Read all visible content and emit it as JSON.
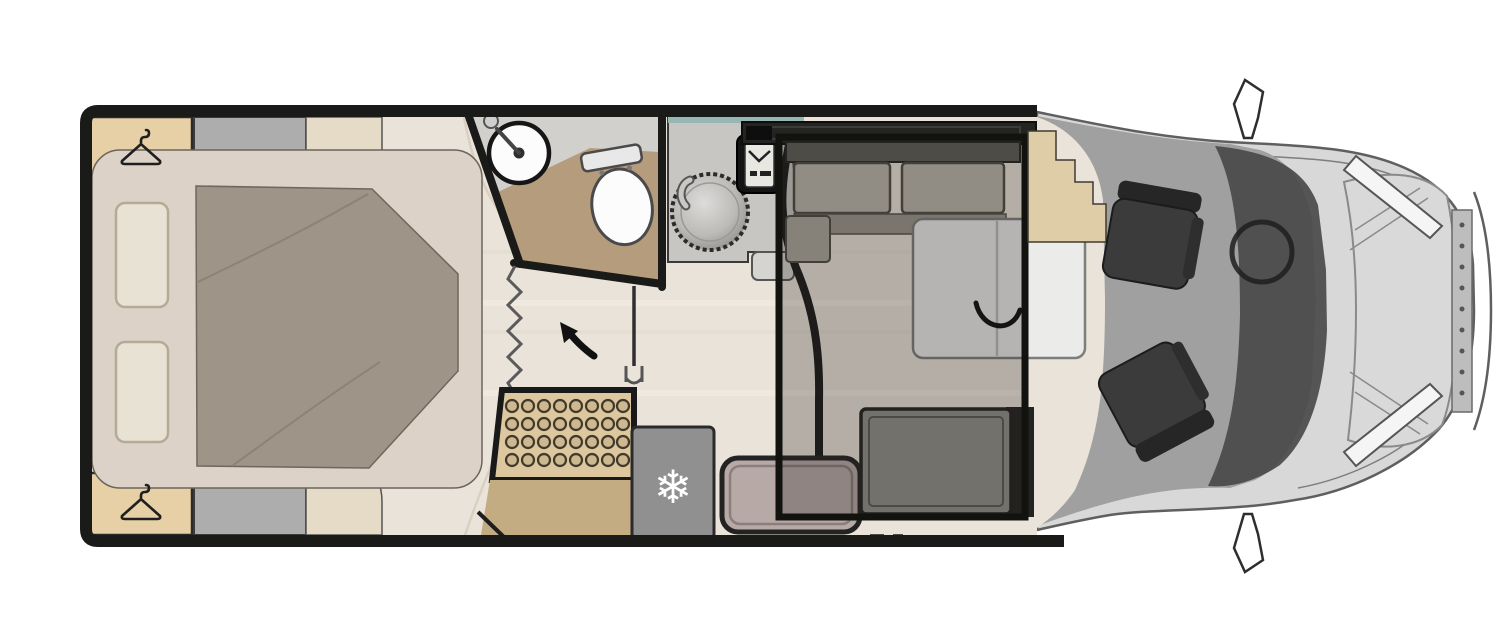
{
  "meta": {
    "description": "Top-view motorhome floor plan with rear island bed, wardrobes, washroom, separate shower, kitchen, dinette with drop-down bed outline, entry bench, fridge and driver cab with two swivel seats",
    "snowflake_glyph": "❄"
  },
  "icons": {
    "hanger": {
      "name": "hanger-icon",
      "count": 2
    },
    "snowflake": {
      "name": "snowflake-icon"
    },
    "arrow": {
      "name": "entry-arrow-icon"
    },
    "steering_wheel": {
      "name": "steering-wheel-icon"
    }
  },
  "colors": {
    "wall": "#1a1a19",
    "floor": "#eae3d9",
    "floor_streak_light": "#f4efe7",
    "floor_streak_dark": "#d9cfc0",
    "wardrobe": "#e7d0a6",
    "cabinet_gray": "#adadad",
    "corner_step": "#e6dbc6",
    "bed_base": "#dcd2c7",
    "pillow": "#e8e2d4",
    "pillow_edge": "#b5aa95",
    "duvet": "#9e9487",
    "duvet_edge": "#6e675d",
    "bathroom_floor": "#d2d0cc",
    "vanity": "#b59c7c",
    "fixture_white": "#fcfcfc",
    "fixture_edge": "#4a4a4a",
    "counter": "#c8c6c2",
    "counter_shelf": "#d6d4d0",
    "sink_metal": "#c2c1be",
    "hob_black": "#141414",
    "hob_panel": "#e9e7e2",
    "upper_unit_dark": "#242422",
    "window_teal": "#96b7b3",
    "shower_tray": "#dcc79e",
    "drain_ring": "#423a2c",
    "drain_fill": "#cdb88f",
    "lower_cabinet": "#c3ab82",
    "fridge": "#909090",
    "snowflake_white": "#ffffff",
    "bench_back": "#5d5c55",
    "bench_cushion": "#bab6ab",
    "bench_front": "#9a968b",
    "table_white": "#ebebe9",
    "side_bench": "#918f88",
    "entry_bench": "#b7a9a6",
    "overlay_fill": "rgba(38,34,28,0.27)",
    "overlay_border": "#12120f",
    "step_counter": "#dfcda8",
    "cab_shell": "#d8d8d8",
    "cab_floor": "#a0a0a0",
    "dash_dark": "#474747",
    "glass": "#d9d9d9",
    "seat_dark": "#3b3b3b",
    "seat_back": "#262626",
    "mirror_white": "#ffffff",
    "headlight": "#f5f5f5",
    "grille": "#bdbdbd",
    "arrow_black": "#111111"
  }
}
